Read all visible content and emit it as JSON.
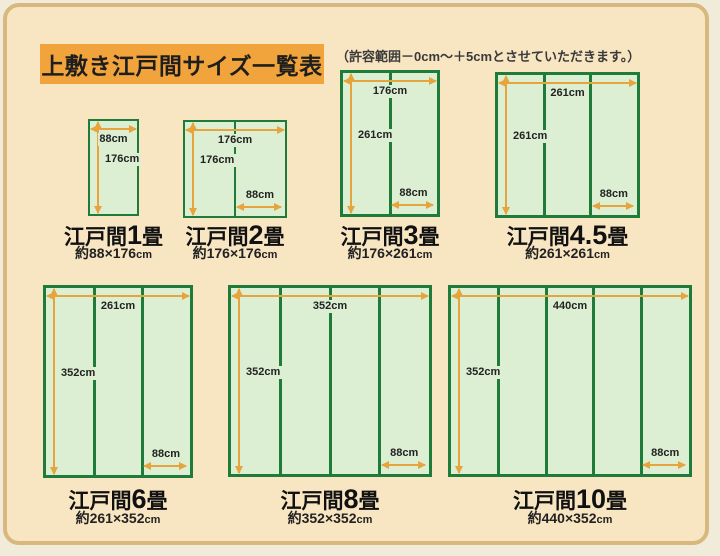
{
  "page": {
    "title": "上敷き江戸間サイズ一覧表",
    "note": "（許容範囲－0cm～＋5cmとさせていただきます。）"
  },
  "colors": {
    "outer_background": "#F1ECD9",
    "frame_background": "#F8E6C2",
    "frame_border": "#D8B87E",
    "title_background": "#F2A43C",
    "mat_fill": "#DCEFD2",
    "mat_border": "#1E7B39",
    "arrow": "#E8A43C",
    "text": "#222222"
  },
  "diagrams": [
    {
      "name_prefix": "江戸間",
      "name_num": "1",
      "name_suffix": "畳",
      "size_value": "約88×176",
      "size_unit": "cm",
      "width_label": "88cm",
      "height_label": "176cm",
      "mat_width_label": null,
      "mat_columns": 1
    },
    {
      "name_prefix": "江戸間",
      "name_num": "2",
      "name_suffix": "畳",
      "size_value": "約176×176",
      "size_unit": "cm",
      "width_label": "176cm",
      "height_label": "176cm",
      "mat_width_label": "88cm",
      "mat_columns": 2
    },
    {
      "name_prefix": "江戸間",
      "name_num": "3",
      "name_suffix": "畳",
      "size_value": "約176×261",
      "size_unit": "cm",
      "width_label": "176cm",
      "height_label": "261cm",
      "mat_width_label": "88cm",
      "mat_columns": 2
    },
    {
      "name_prefix": "江戸間",
      "name_num": "4.5",
      "name_suffix": "畳",
      "size_value": "約261×261",
      "size_unit": "cm",
      "width_label": "261cm",
      "height_label": "261cm",
      "mat_width_label": "88cm",
      "mat_columns": 3
    },
    {
      "name_prefix": "江戸間",
      "name_num": "6",
      "name_suffix": "畳",
      "size_value": "約261×352",
      "size_unit": "cm",
      "width_label": "261cm",
      "height_label": "352cm",
      "mat_width_label": "88cm",
      "mat_columns": 3
    },
    {
      "name_prefix": "江戸間",
      "name_num": "8",
      "name_suffix": "畳",
      "size_value": "約352×352",
      "size_unit": "cm",
      "width_label": "352cm",
      "height_label": "352cm",
      "mat_width_label": "88cm",
      "mat_columns": 4
    },
    {
      "name_prefix": "江戸間",
      "name_num": "10",
      "name_suffix": "畳",
      "size_value": "約440×352",
      "size_unit": "cm",
      "width_label": "440cm",
      "height_label": "352cm",
      "mat_width_label": "88cm",
      "mat_columns": 5
    }
  ]
}
